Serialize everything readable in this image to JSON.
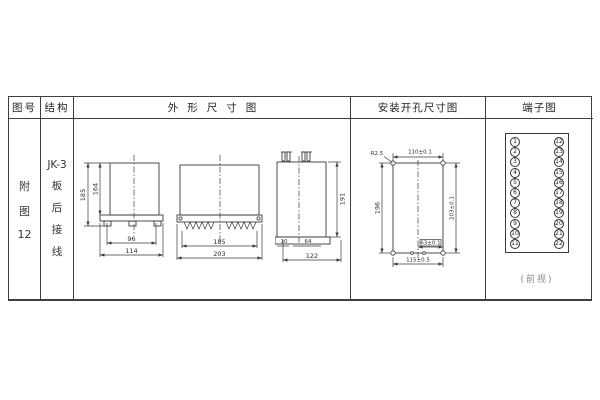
{
  "table": {
    "headers": {
      "figure_no": "图号",
      "structure": "结构",
      "outline": "外形尺寸图",
      "mounting": "安装开孔尺寸图",
      "terminals": "端子图"
    },
    "figure_no_lines": [
      "附",
      "图",
      "12"
    ],
    "structure_lines": [
      "JK-3",
      "板",
      "后",
      "接",
      "线"
    ]
  },
  "outline": {
    "side_view": {
      "height_total": "185",
      "height_body": "164",
      "width_inner": "96",
      "width_total": "114"
    },
    "front_view": {
      "width_inner": "185",
      "width_total": "203"
    },
    "rear_view": {
      "height": "191",
      "depth_small_1": "10",
      "depth_small_2": "64",
      "depth_total": "122"
    }
  },
  "mounting": {
    "corner_radius": "R2.5",
    "hole_span_horizontal": "110±0.1",
    "cutout_height": "196",
    "hole_span_vertical": "203±0.1",
    "cutout_width": "115±0.5",
    "bottom_span": "63±0.1"
  },
  "terminal": {
    "left": [
      "1",
      "2",
      "3",
      "4",
      "5",
      "6",
      "7",
      "8",
      "9",
      "10",
      "11"
    ],
    "right": [
      "12",
      "13",
      "14",
      "15",
      "16",
      "17",
      "18",
      "19",
      "20",
      "21",
      "22"
    ],
    "caption": "(前视)"
  }
}
